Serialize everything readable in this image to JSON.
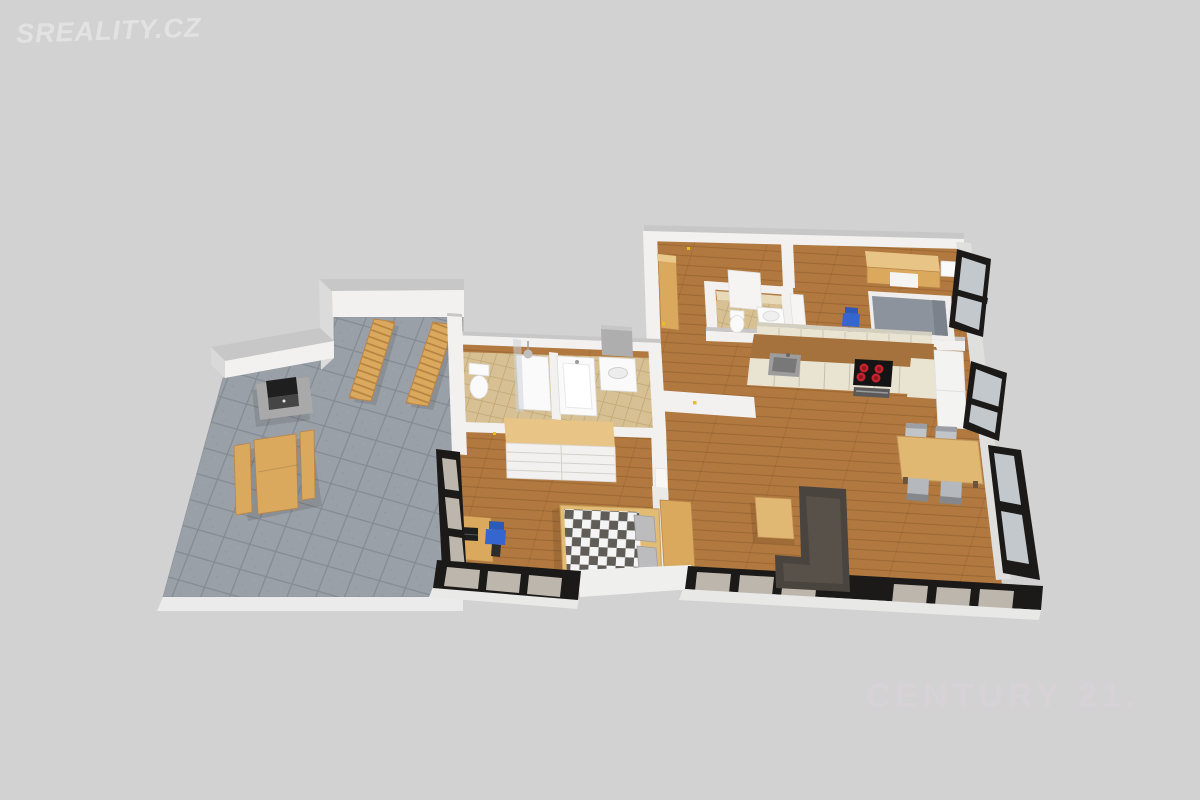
{
  "watermarks": {
    "sreality": {
      "text": "SREALITY.CZ",
      "color": "#e4e4e4"
    },
    "century21": {
      "text": "CENTURY 21.",
      "color": "#d9d3d6"
    }
  },
  "floorplan": {
    "type": "3d-isometric-floor-plan",
    "palette": {
      "bg": "#d2d2d2",
      "wmLeft": "#e4e4e4",
      "wmRight": "#d9d3d6",
      "wall": "#f2f1ef",
      "wallTop": "#c7c7c7",
      "wallOuter": "#dfdfde",
      "woodFloor": "#b1793f",
      "terraceTile": "#9aa0a7",
      "bathTile": "#d7c194",
      "furnWood": "#daa95e",
      "furnWoodD": "#b9854a",
      "wardrobeTop": "#e8c587",
      "counter": "#a5713d",
      "cabinet": "#e9e4d2",
      "cooktop": "#141414",
      "burner": "#c2232e",
      "sofa": "#4a443e",
      "bedGray": "#8d939c",
      "chairBlue": "#3566cf",
      "winFrame": "#1c1a18",
      "winGlass": "#bdb6ac",
      "fixture": "#fafafa",
      "lightDot": "#e5c21d"
    },
    "rooms": [
      {
        "id": "terrace",
        "floor": "stone-tile-gray",
        "furniture": [
          "sun-lounger",
          "sun-lounger",
          "grill",
          "picnic-table-with-benches"
        ]
      },
      {
        "id": "bathroom",
        "floor": "ceramic-tile-beige",
        "furniture": [
          "toilet",
          "shower",
          "bathtub",
          "vanity-sink",
          "mirror-cabinet"
        ]
      },
      {
        "id": "wc",
        "floor": "ceramic-tile-beige",
        "furniture": [
          "toilet",
          "washbasin",
          "door"
        ]
      },
      {
        "id": "hallway",
        "floor": "wood",
        "furniture": [
          "cabinet"
        ]
      },
      {
        "id": "bedroom-1",
        "floor": "wood",
        "furniture": [
          "double-bed-checkered",
          "wardrobe-shelving",
          "desk",
          "laptop",
          "office-chair-blue"
        ]
      },
      {
        "id": "bedroom-2",
        "floor": "wood",
        "furniture": [
          "double-bed-gray",
          "wardrobe",
          "nightstand",
          "desk",
          "office-chair-blue",
          "door"
        ]
      },
      {
        "id": "kitchen",
        "floor": "wood",
        "furniture": [
          "kitchen-counter",
          "sink",
          "cooktop-4-burner",
          "oven",
          "upper-cabinets",
          "tall-cabinet",
          "fridge-column"
        ]
      },
      {
        "id": "living-room",
        "floor": "wood",
        "furniture": [
          "corner-sofa-dark",
          "coffee-table",
          "sideboard",
          "dining-table",
          "dining-chair",
          "dining-chair",
          "dining-chair",
          "dining-chair"
        ]
      }
    ],
    "windows": {
      "frame_color": "#1c1a18",
      "locations": [
        "bedroom-1-left-band",
        "bedroom-1-bottom-band",
        "living-room-bottom-band",
        "right-wall-top-panel",
        "right-wall-middle-panel",
        "right-wall-bottom-panel"
      ]
    }
  }
}
